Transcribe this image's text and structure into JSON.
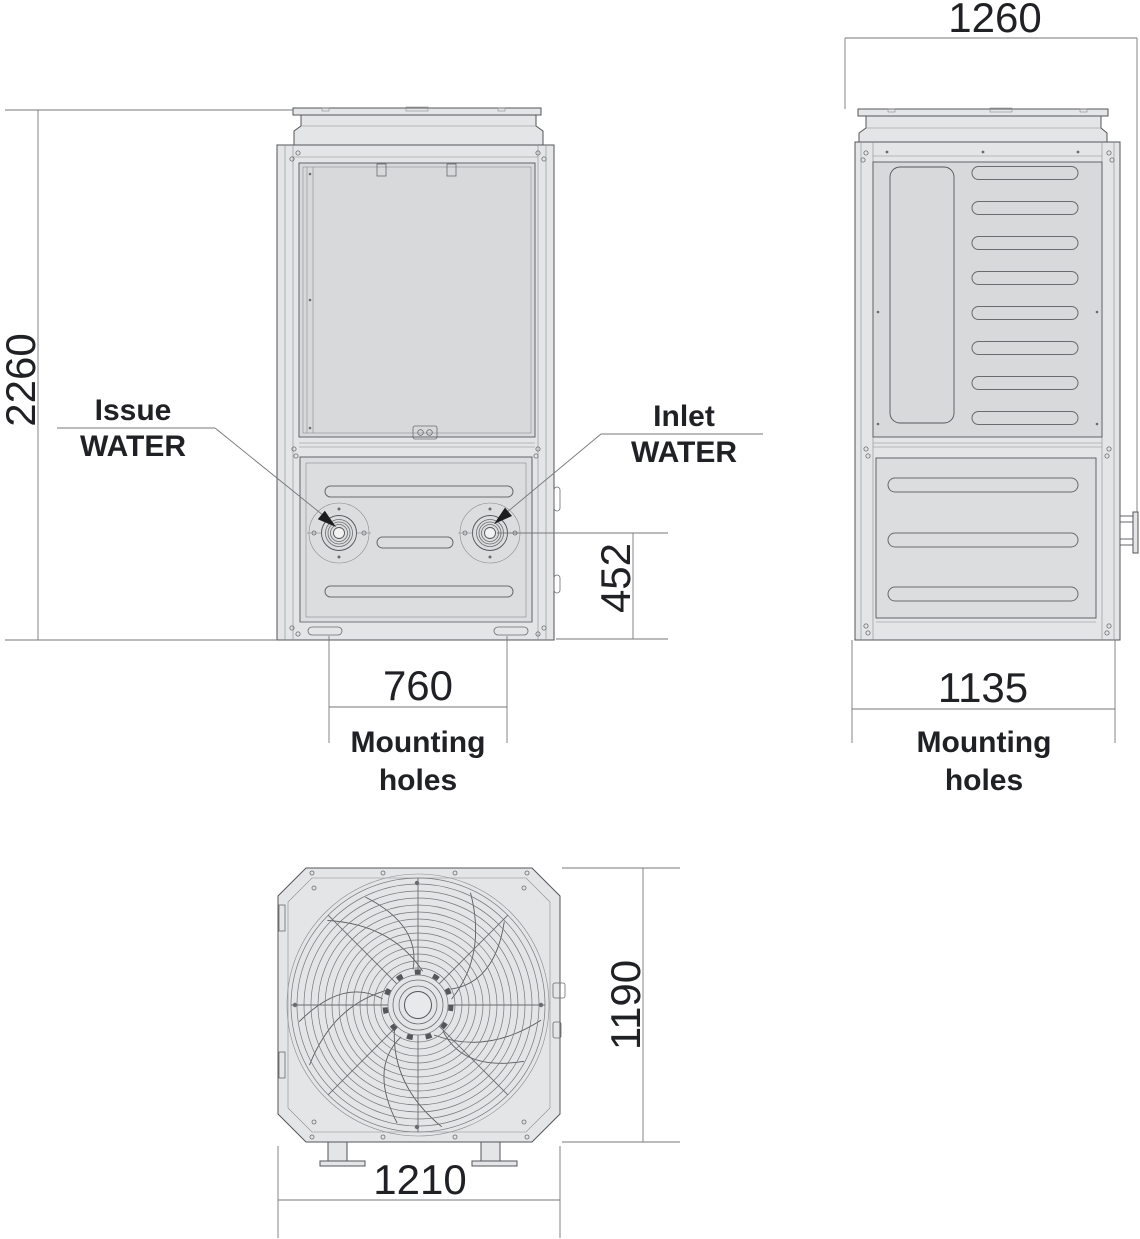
{
  "colors": {
    "background": "#ffffff",
    "body_fill": "#e4e5e7",
    "panel_fill": "#d8d9db",
    "panel_fill_alt": "#dcddde",
    "outline": "#54555a",
    "detail_line": "#8a8b8e",
    "dimension_line": "#76777a",
    "text": "#202124",
    "arrow_fill": "#1c1d1f"
  },
  "front": {
    "dim_height": "2260",
    "dim_water_outlet_height": "452",
    "dim_mounting_width": "760",
    "mounting_caption_1": "Mounting",
    "mounting_caption_2": "holes",
    "issue_label_1": "Issue",
    "issue_label_2": "WATER",
    "inlet_label_1": "Inlet",
    "inlet_label_2": "WATER"
  },
  "side": {
    "dim_width": "1260",
    "dim_mounting_width": "1135",
    "mounting_caption_1": "Mounting",
    "mounting_caption_2": "holes"
  },
  "bottom": {
    "dim_width": "1210",
    "dim_depth": "1190"
  }
}
